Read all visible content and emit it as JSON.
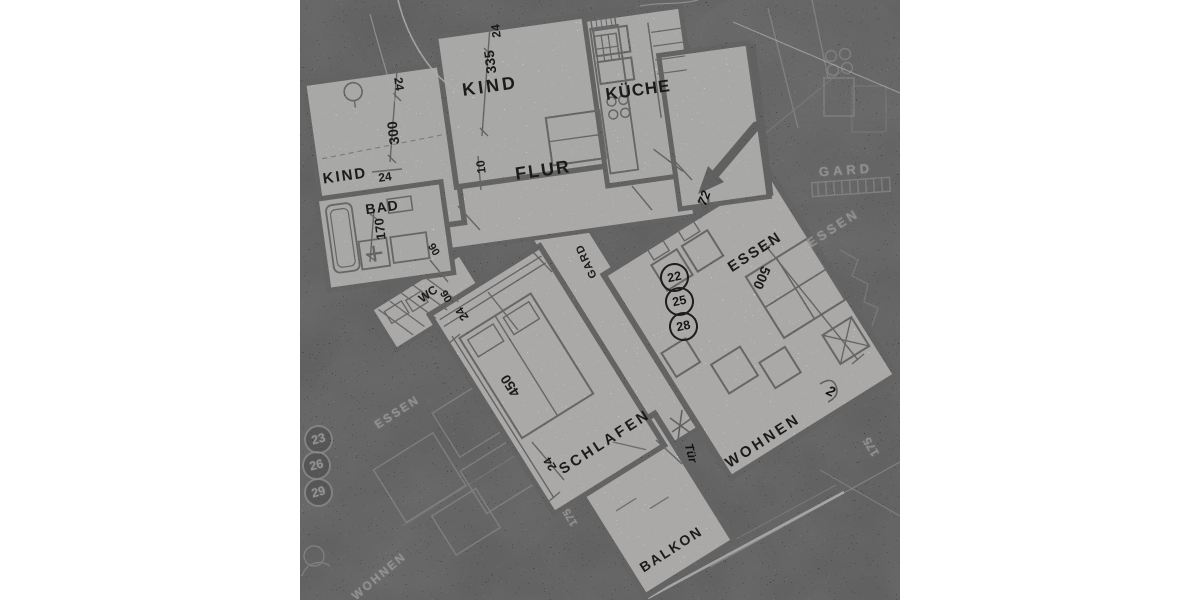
{
  "image": {
    "description": "High-contrast photographic scan of an architectural apartment floor plan, white plan on black background",
    "type": "floor-plan-photo"
  },
  "rooms": {
    "kind_left": "KIND",
    "kind_center": "KIND",
    "kueche": "KÜCHE",
    "flur": "FLUR",
    "bad": "BAD",
    "wc": "WC",
    "gard": "GARD",
    "essen": "ESSEN",
    "schlafen": "SCHLAFEN",
    "wohnen": "WOHNEN",
    "balkon": "BALKON"
  },
  "dims": {
    "kind_left_top": "24",
    "kind_left_height": "300",
    "kind_left_door": "24",
    "kind_center_top": "24",
    "kind_center_height": "335",
    "flur_niche": "10",
    "bad_width": "170",
    "bad_wall": "90",
    "wc_width": "90",
    "schlafen_top": "24",
    "schlafen_length": "450",
    "schlafen_door": "24",
    "essen_length": "500"
  },
  "units": {
    "current": [
      "22",
      "25",
      "28"
    ],
    "ghost": [
      "23",
      "26",
      "29"
    ]
  },
  "handwritten": {
    "entry_mark": "72",
    "door_note": "Tür",
    "corner_mark": "2"
  },
  "ghost_labels": {
    "gard": "GARD",
    "essen_right": "ESSEN",
    "essen_left": "ESSEN",
    "wohnen": "WOHNEN",
    "dim_right": "175",
    "dim_left": "175"
  },
  "colors": {
    "page_background": "#ffffff",
    "photo_black": "#0e0e0e",
    "paper": "#d8d5d0",
    "ink": "#161616",
    "ghost": "#9a9a9a"
  }
}
